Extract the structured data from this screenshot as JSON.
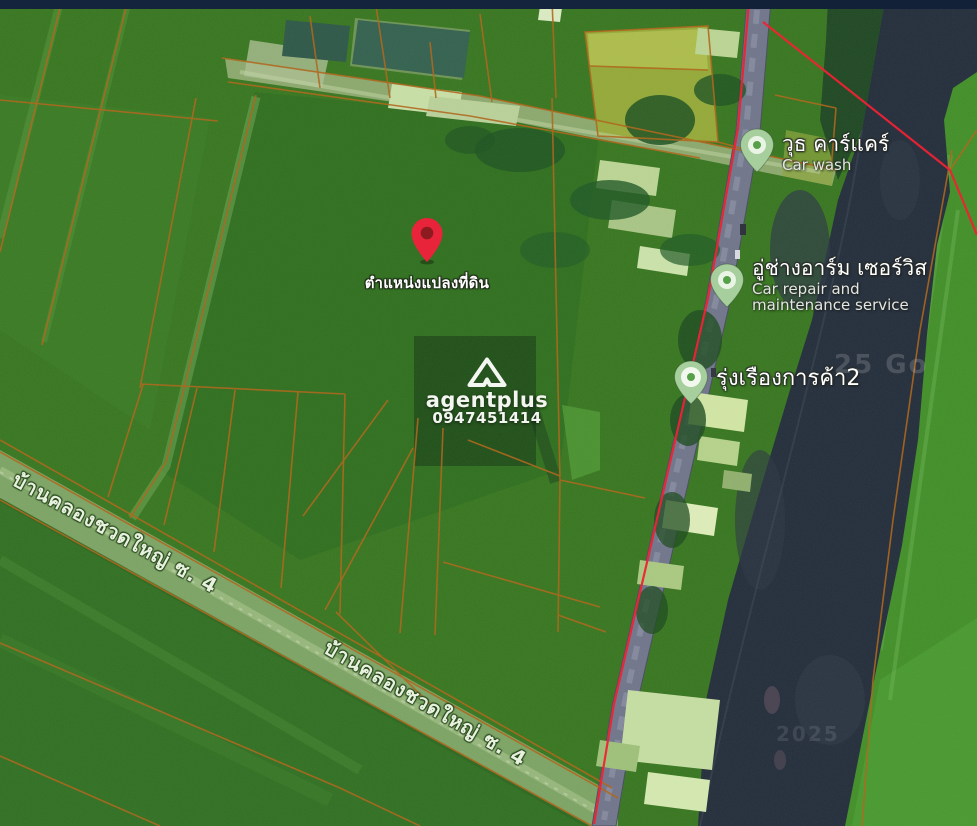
{
  "map": {
    "land_pin": {
      "label": "ตำแหน่งแปลงที่ดิน"
    },
    "watermark": {
      "brand": "agentplus",
      "phone": "0947451414"
    },
    "pois": [
      {
        "name_th": "วุธ คาร์แคร์",
        "name_en": "Car wash"
      },
      {
        "name_th": "อู่ช่างอาร์ม เซอร์วิส",
        "name_en": "Car repair and maintenance service"
      },
      {
        "name_th": "รุ่งเรืองการค้า2",
        "name_en": ""
      }
    ],
    "road_labels": [
      "บ้านคลองชวดใหญ่ ซ. 4",
      "บ้านคลองชวดใหญ่ ซ. 4"
    ],
    "imagery_credit_fragments": [
      "25 Go",
      "2025"
    ],
    "colors": {
      "field_green": "#37751f",
      "parcel_line_orange": "#ad6418",
      "boundary_red": "#ee1b2d",
      "river_dark": "#232d3a",
      "pin_red": "#e8243a",
      "poi_pin_green": "#a7cf9d",
      "top_bar_navy": "#15243d"
    }
  }
}
